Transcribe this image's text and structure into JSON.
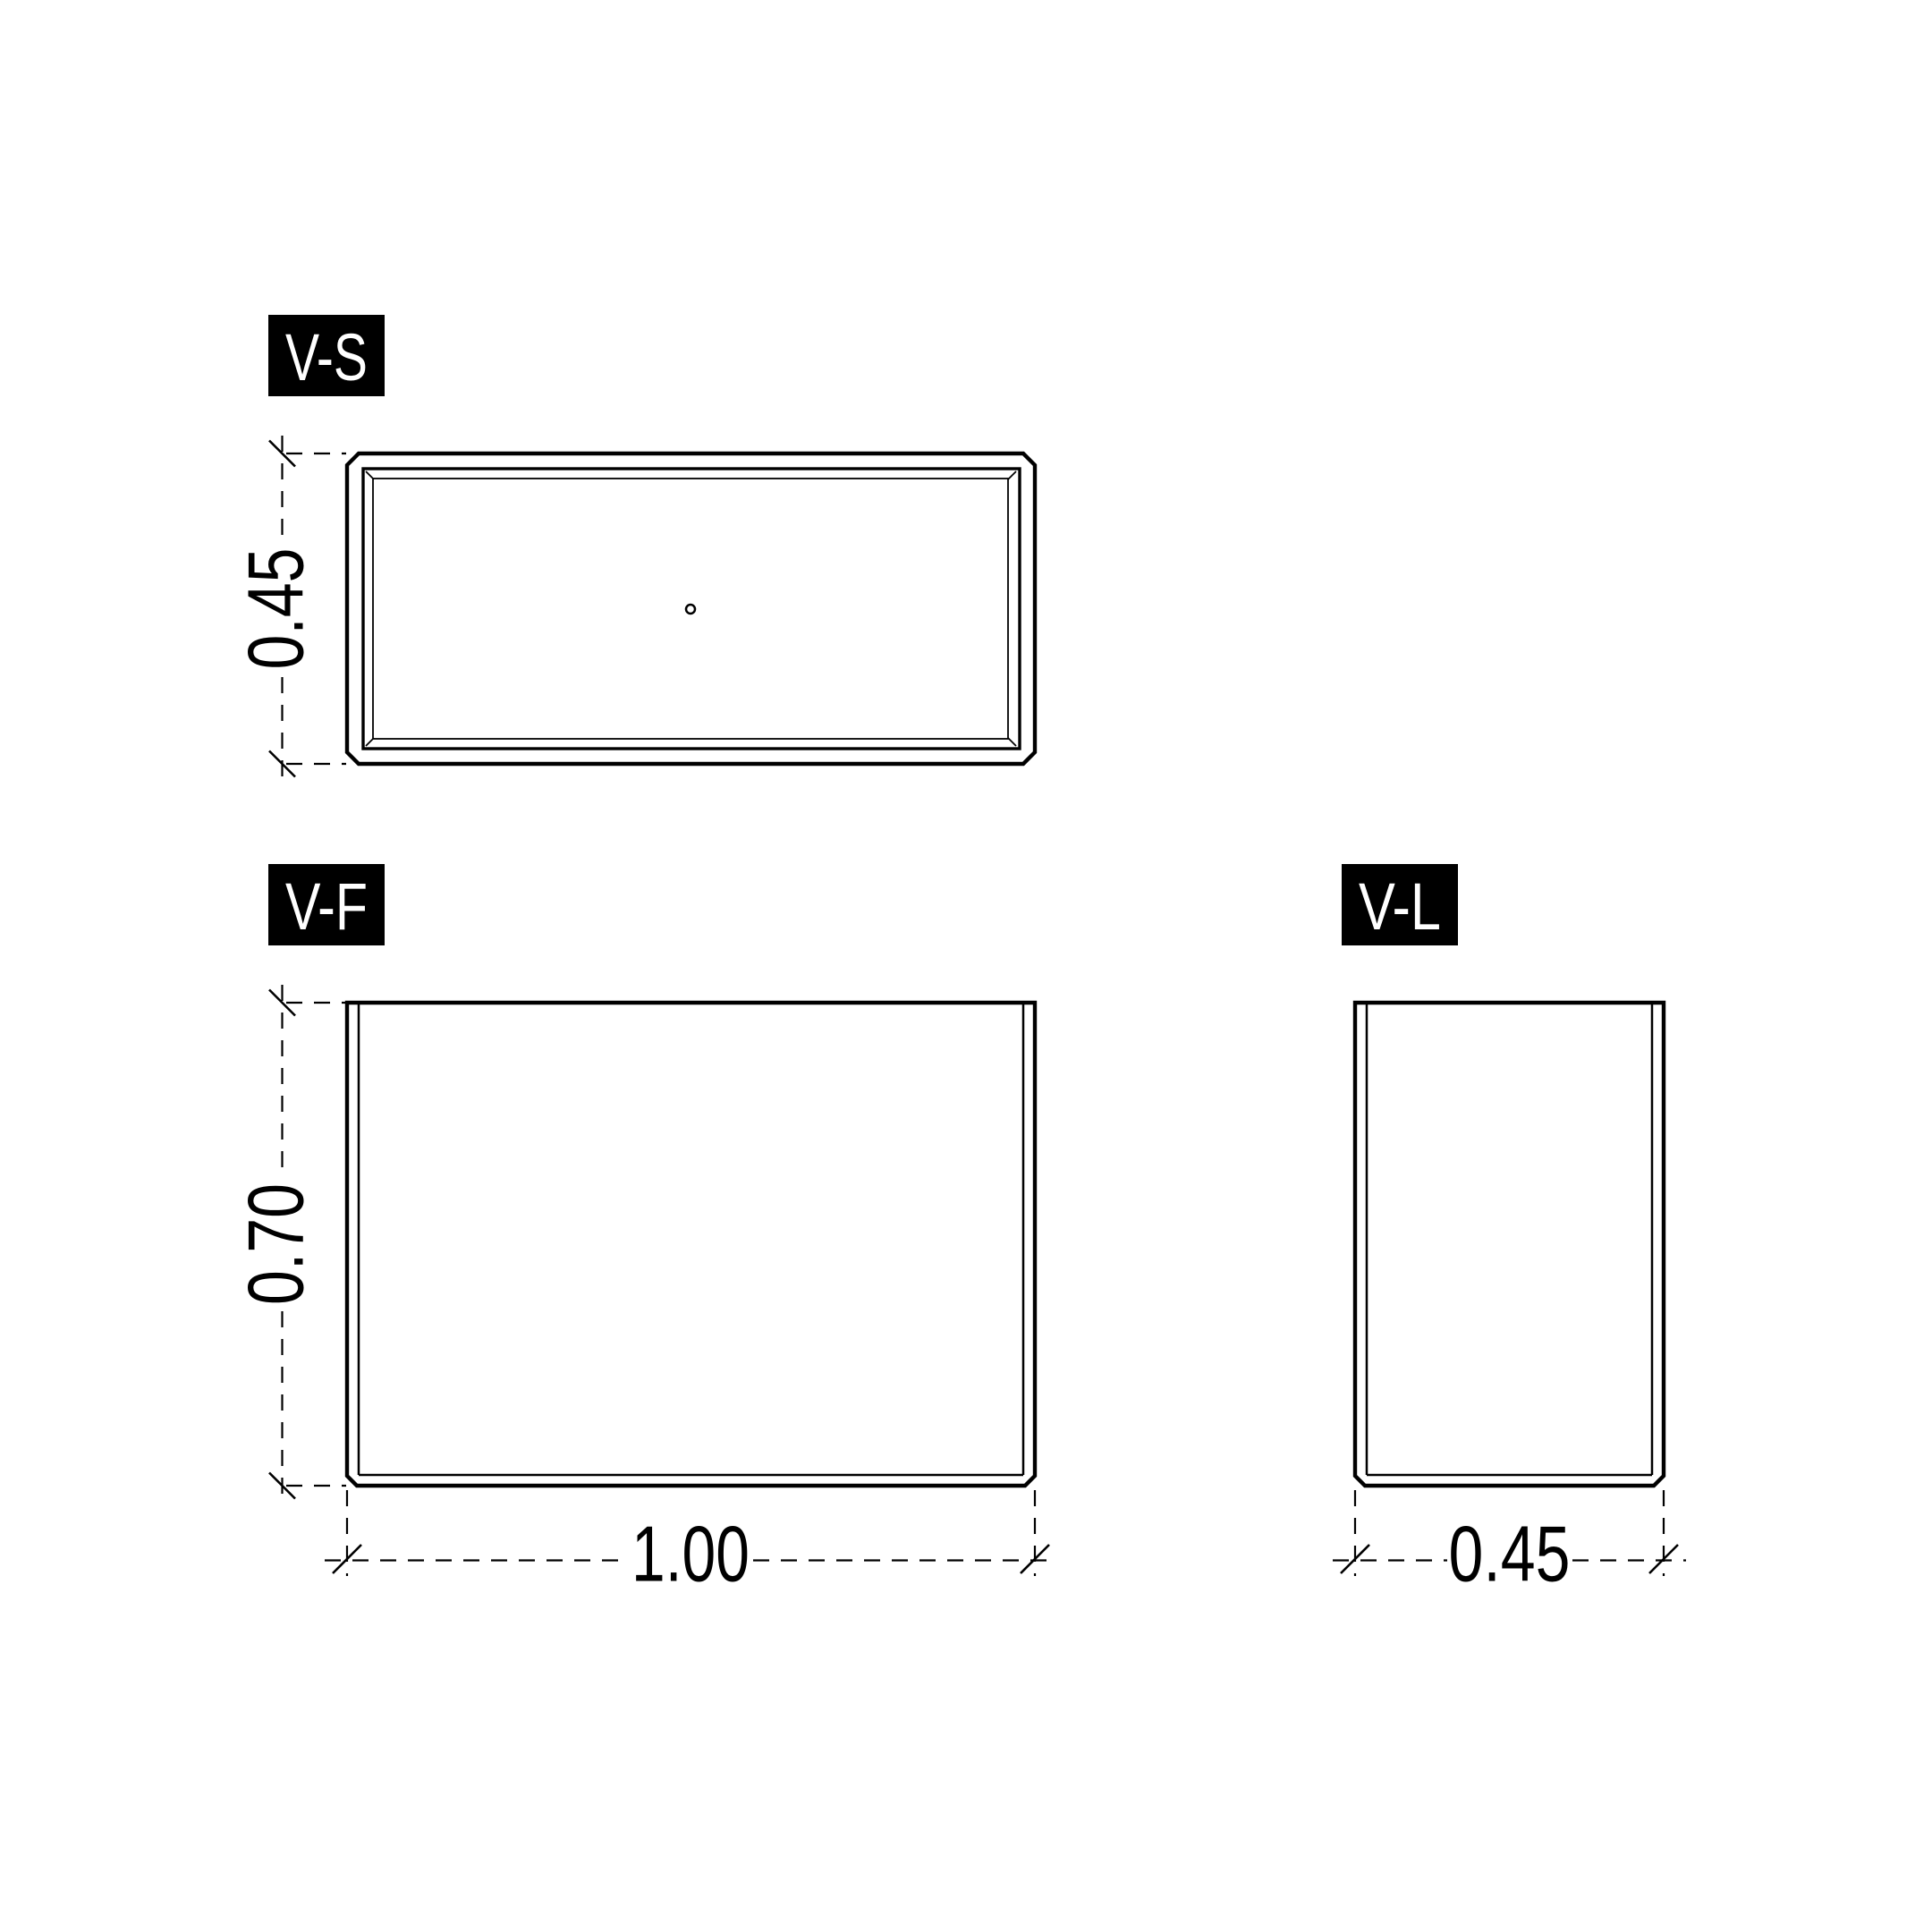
{
  "drawing": {
    "colors": {
      "background": "#ffffff",
      "line": "#000000",
      "label_bg": "#000000",
      "label_text": "#ffffff"
    },
    "views": {
      "top": {
        "label": "V-S",
        "height_dim": "0.45"
      },
      "front": {
        "label": "V-F",
        "height_dim": "0.70",
        "width_dim": "1.00"
      },
      "side": {
        "label": "V-L",
        "width_dim": "0.45"
      }
    }
  }
}
